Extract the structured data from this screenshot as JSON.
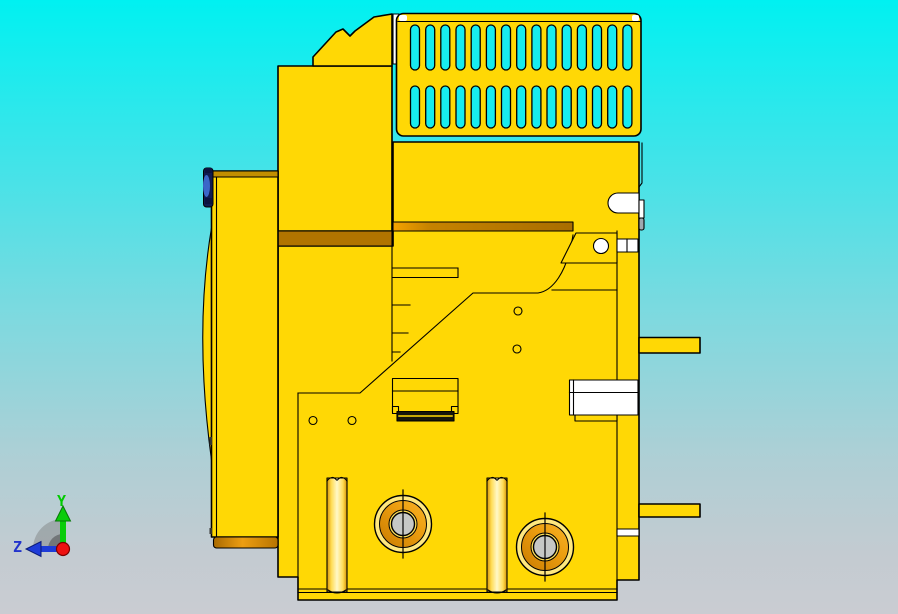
{
  "viewport": {
    "type": "cad-3d-view",
    "description": "side elevation view of a yellow machine part (CAD shaded-with-edges display)",
    "background": {
      "top_color": "#00F1F1",
      "upper_mid_color": "#3EE4E9",
      "mid_color": "#7FD9DF",
      "lower_mid_color": "#AFCfd5",
      "bottom_color": "#CACCD2"
    }
  },
  "model": {
    "name": "yellow machine body - side view",
    "body_color": "#FFD805",
    "edge_color": "#000000",
    "shadow_band_color": "#B17400",
    "shadow_band_bright": "#F0A008",
    "highlight_color": "#FFF8C8",
    "hole_center_color": "#C6C8C6",
    "vent_grille": {
      "rows": 2,
      "slots_per_row": 15,
      "slot_color": "#17ECEF"
    },
    "hardware_colors": {
      "white_fixture": "#FFFFFF",
      "pin_metal_gray": "#9FA8B0",
      "hinge_blue_dark": "#101C52",
      "hinge_blue_light": "#3B66C8"
    }
  },
  "triad": {
    "y_axis": {
      "label": "Y",
      "color": "#00CC00"
    },
    "z_axis": {
      "label": "Z",
      "color": "#2233CC"
    },
    "origin_color": "#EE1111",
    "fan_color": "#555555"
  }
}
